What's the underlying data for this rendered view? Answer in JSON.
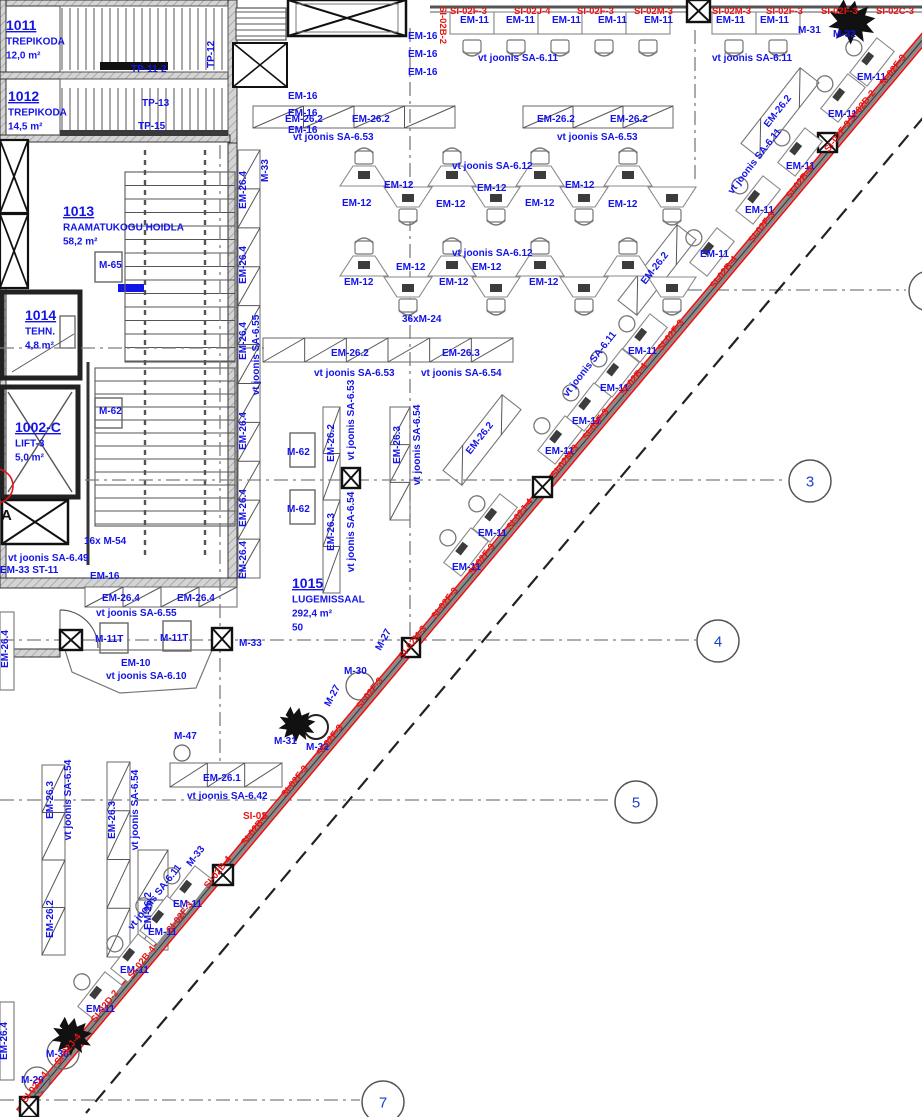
{
  "colors": {
    "annotation_blue": "#1414e8",
    "alert_red": "#e81414",
    "wall_gray": "#c9c9c9",
    "line_dark": "#333333",
    "grid_number_blue": "#1b3fd0"
  },
  "rooms": [
    {
      "number": "1011",
      "name": "TREPIKODA",
      "area": "12,0 m²",
      "x": 6,
      "y": 30
    },
    {
      "number": "1012",
      "name": "TREPIKODA",
      "area": "14,5 m²",
      "x": 8,
      "y": 101
    },
    {
      "number": "1013",
      "name": "RAAMATUKOGU HOIDLA",
      "area": "58,2 m²",
      "x": 63,
      "y": 216
    },
    {
      "number": "1014",
      "name": "TEHN.",
      "area": "4,8 m²",
      "x": 25,
      "y": 320
    },
    {
      "number": "1002-C",
      "name": "LIFT-3",
      "area": "5,0 m²",
      "x": 15,
      "y": 432
    },
    {
      "number": "1015",
      "name": "LUGEMISSAAL",
      "area": "292,4 m²",
      "capacity": "50",
      "x": 292,
      "y": 588
    }
  ],
  "grid_bubbles": [
    {
      "label": "3",
      "x": 810,
      "y": 481
    },
    {
      "label": "4",
      "x": 718,
      "y": 641
    },
    {
      "label": "5",
      "x": 636,
      "y": 802
    },
    {
      "label": "7",
      "x": 383,
      "y": 1102
    }
  ],
  "labels": [
    {
      "t": "TP-11-2",
      "x": 131,
      "y": 72
    },
    {
      "t": "TP-13",
      "x": 142,
      "y": 106
    },
    {
      "t": "TP-15",
      "x": 138,
      "y": 129
    },
    {
      "t": "TP-12",
      "x": 214,
      "y": 68,
      "r": -90
    },
    {
      "t": "M-33",
      "x": 268,
      "y": 182,
      "r": -90
    },
    {
      "t": "M-65",
      "x": 99,
      "y": 268
    },
    {
      "t": "M-62",
      "x": 99,
      "y": 414
    },
    {
      "t": "EM-16",
      "x": 408,
      "y": 39
    },
    {
      "t": "EM-16",
      "x": 408,
      "y": 57
    },
    {
      "t": "EM-16",
      "x": 408,
      "y": 75
    },
    {
      "t": "EM-16",
      "x": 288,
      "y": 99
    },
    {
      "t": "EM-16",
      "x": 288,
      "y": 116
    },
    {
      "t": "EM-16",
      "x": 288,
      "y": 133
    },
    {
      "t": "EM-11",
      "x": 460,
      "y": 23
    },
    {
      "t": "EM-11",
      "x": 506,
      "y": 23
    },
    {
      "t": "EM-11",
      "x": 552,
      "y": 23
    },
    {
      "t": "EM-11",
      "x": 598,
      "y": 23
    },
    {
      "t": "EM-11",
      "x": 644,
      "y": 23
    },
    {
      "t": "EM-11",
      "x": 716,
      "y": 23
    },
    {
      "t": "EM-11",
      "x": 760,
      "y": 23
    },
    {
      "t": "vt joonis SA-6.11",
      "x": 478,
      "y": 61
    },
    {
      "t": "vt joonis SA-6.11",
      "x": 712,
      "y": 61
    },
    {
      "t": "M-31",
      "x": 798,
      "y": 33
    },
    {
      "t": "M-32",
      "x": 833,
      "y": 37
    },
    {
      "t": "SI-02F-3",
      "x": 450,
      "y": 14,
      "c": "r",
      "s": 9.5
    },
    {
      "t": "SI-02J-4",
      "x": 514,
      "y": 14,
      "c": "r",
      "s": 9.5
    },
    {
      "t": "SI-02F-3",
      "x": 577,
      "y": 14,
      "c": "r",
      "s": 9.5
    },
    {
      "t": "SI-02M-3",
      "x": 634,
      "y": 14,
      "c": "r",
      "s": 9.5
    },
    {
      "t": "SI-02M-3",
      "x": 712,
      "y": 14,
      "c": "r",
      "s": 9.5
    },
    {
      "t": "SI-02F-3",
      "x": 766,
      "y": 14,
      "c": "r",
      "s": 9.5
    },
    {
      "t": "SI-02F-3",
      "x": 821,
      "y": 14,
      "c": "r",
      "s": 9.5
    },
    {
      "t": "SI-02C-3",
      "x": 876,
      "y": 14,
      "c": "r",
      "s": 9.5
    },
    {
      "t": "SI-02B-2",
      "x": 440,
      "y": 6,
      "r": 90,
      "c": "r",
      "s": 9.5
    },
    {
      "t": "EM-26.2",
      "x": 285,
      "y": 122
    },
    {
      "t": "EM-26.2",
      "x": 352,
      "y": 122
    },
    {
      "t": "EM-26.2",
      "x": 537,
      "y": 122
    },
    {
      "t": "EM-26.2",
      "x": 610,
      "y": 122
    },
    {
      "t": "vt joonis SA-6.53",
      "x": 293,
      "y": 140
    },
    {
      "t": "vt joonis SA-6.53",
      "x": 557,
      "y": 140
    },
    {
      "t": "vt joonis SA-6.12",
      "x": 452,
      "y": 169
    },
    {
      "t": "EM-12",
      "x": 384,
      "y": 188
    },
    {
      "t": "EM-12",
      "x": 342,
      "y": 206
    },
    {
      "t": "EM-12",
      "x": 477,
      "y": 191
    },
    {
      "t": "EM-12",
      "x": 436,
      "y": 207
    },
    {
      "t": "EM-12",
      "x": 565,
      "y": 188
    },
    {
      "t": "EM-12",
      "x": 525,
      "y": 206
    },
    {
      "t": "EM-12",
      "x": 608,
      "y": 207
    },
    {
      "t": "vt joonis SA-6.12",
      "x": 452,
      "y": 256
    },
    {
      "t": "EM-12",
      "x": 396,
      "y": 270
    },
    {
      "t": "EM-12",
      "x": 472,
      "y": 270
    },
    {
      "t": "EM-12",
      "x": 344,
      "y": 285
    },
    {
      "t": "EM-12",
      "x": 439,
      "y": 285
    },
    {
      "t": "EM-12",
      "x": 529,
      "y": 285
    },
    {
      "t": "36xM-24",
      "x": 402,
      "y": 322
    },
    {
      "t": "EM-26.2",
      "x": 331,
      "y": 356
    },
    {
      "t": "EM-26.3",
      "x": 442,
      "y": 356
    },
    {
      "t": "vt joonis SA-6.53",
      "x": 314,
      "y": 376
    },
    {
      "t": "vt joonis SA-6.54",
      "x": 421,
      "y": 376
    },
    {
      "t": "EM-26.2",
      "x": 334,
      "y": 443,
      "r": -90,
      "a": "m"
    },
    {
      "t": "vt joonis SA-6.53",
      "x": 354,
      "y": 420,
      "r": -90,
      "a": "m"
    },
    {
      "t": "EM-26.3",
      "x": 334,
      "y": 532,
      "r": -90,
      "a": "m"
    },
    {
      "t": "vt joonis SA-6.54",
      "x": 354,
      "y": 532,
      "r": -90,
      "a": "m"
    },
    {
      "t": "EM-26.3",
      "x": 400,
      "y": 445,
      "r": -90,
      "a": "m"
    },
    {
      "t": "vt joonis SA-6.54",
      "x": 420,
      "y": 445,
      "r": -90,
      "a": "m"
    },
    {
      "t": "M-62",
      "x": 287,
      "y": 455
    },
    {
      "t": "M-62",
      "x": 287,
      "y": 512
    },
    {
      "t": "EM-26.4",
      "x": 246,
      "y": 190,
      "r": -90,
      "a": "m"
    },
    {
      "t": "EM-26.4",
      "x": 246,
      "y": 265,
      "r": -90,
      "a": "m"
    },
    {
      "t": "EM-26.4",
      "x": 246,
      "y": 341,
      "r": -90,
      "a": "m"
    },
    {
      "t": "EM-26.4",
      "x": 246,
      "y": 431,
      "r": -90,
      "a": "m"
    },
    {
      "t": "EM-26.4",
      "x": 246,
      "y": 508,
      "r": -90,
      "a": "m"
    },
    {
      "t": "EM-26.4",
      "x": 246,
      "y": 560,
      "r": -90,
      "a": "m"
    },
    {
      "t": "vt joonis SA-6.55",
      "x": 259,
      "y": 355,
      "r": -90,
      "a": "m"
    },
    {
      "t": "16x M-54",
      "x": 84,
      "y": 544
    },
    {
      "t": "vt joonis SA-6.49",
      "x": 8,
      "y": 561
    },
    {
      "t": "EM-33 ST-11",
      "x": 0,
      "y": 573
    },
    {
      "t": "EM-16",
      "x": 90,
      "y": 579
    },
    {
      "t": "EM-26.4",
      "x": 102,
      "y": 601
    },
    {
      "t": "EM-26.4",
      "x": 177,
      "y": 601
    },
    {
      "t": "vt joonis SA-6.55",
      "x": 96,
      "y": 616
    },
    {
      "t": "M-11T",
      "x": 95,
      "y": 642
    },
    {
      "t": "M-11T",
      "x": 160,
      "y": 641
    },
    {
      "t": "M-33",
      "x": 239,
      "y": 646
    },
    {
      "t": "EM-10",
      "x": 121,
      "y": 666
    },
    {
      "t": "vt joonis SA-6.10",
      "x": 106,
      "y": 679
    },
    {
      "t": "M-47",
      "x": 174,
      "y": 739
    },
    {
      "t": "EM-26.1",
      "x": 203,
      "y": 781
    },
    {
      "t": "vt joonis SA-6.42",
      "x": 187,
      "y": 799
    },
    {
      "t": "SI-02",
      "x": 243,
      "y": 819,
      "c": "r"
    },
    {
      "t": "M-27",
      "x": 386,
      "y": 641,
      "r": -62,
      "a": "m"
    },
    {
      "t": "M-30",
      "x": 344,
      "y": 674
    },
    {
      "t": "M-27",
      "x": 335,
      "y": 697,
      "r": -62,
      "a": "m"
    },
    {
      "t": "M-31",
      "x": 274,
      "y": 744
    },
    {
      "t": "M-32",
      "x": 306,
      "y": 750
    },
    {
      "t": "EM-11",
      "x": 857,
      "y": 80
    },
    {
      "t": "EM-11",
      "x": 828,
      "y": 117
    },
    {
      "t": "EM-11",
      "x": 786,
      "y": 169
    },
    {
      "t": "EM-11",
      "x": 745,
      "y": 213
    },
    {
      "t": "EM-11",
      "x": 700,
      "y": 257
    },
    {
      "t": "EM-11",
      "x": 628,
      "y": 354
    },
    {
      "t": "EM-11",
      "x": 600,
      "y": 391
    },
    {
      "t": "EM-11",
      "x": 572,
      "y": 424
    },
    {
      "t": "EM-11",
      "x": 545,
      "y": 454
    },
    {
      "t": "EM-11",
      "x": 478,
      "y": 536
    },
    {
      "t": "EM-11",
      "x": 452,
      "y": 570
    },
    {
      "t": "EM-11",
      "x": 173,
      "y": 907
    },
    {
      "t": "EM-11",
      "x": 148,
      "y": 935
    },
    {
      "t": "EM-11",
      "x": 120,
      "y": 973
    },
    {
      "t": "EM-11",
      "x": 86,
      "y": 1012
    },
    {
      "t": "EM-26.2",
      "x": 780,
      "y": 113,
      "r": -52,
      "a": "m"
    },
    {
      "t": "EM-26.2",
      "x": 657,
      "y": 270,
      "r": -52,
      "a": "m"
    },
    {
      "t": "EM-26.2",
      "x": 482,
      "y": 440,
      "r": -52,
      "a": "m"
    },
    {
      "t": "vt joonis SA-6.11",
      "x": 757,
      "y": 163,
      "r": -52,
      "a": "m"
    },
    {
      "t": "vt joonis SA-6.11",
      "x": 592,
      "y": 366,
      "r": -52,
      "a": "m"
    },
    {
      "t": "vt joonis SA-6.11",
      "x": 157,
      "y": 899,
      "r": -52,
      "a": "m"
    },
    {
      "t": "M-33",
      "x": 198,
      "y": 858,
      "r": -52,
      "a": "m"
    },
    {
      "t": "EM-26.3",
      "x": 53,
      "y": 800,
      "r": -90,
      "a": "m"
    },
    {
      "t": "vt joonis SA-6.54",
      "x": 71,
      "y": 800,
      "r": -90,
      "a": "m"
    },
    {
      "t": "EM-26.2",
      "x": 53,
      "y": 919,
      "r": -90,
      "a": "m"
    },
    {
      "t": "EM-26.3",
      "x": 115,
      "y": 820,
      "r": -90,
      "a": "m"
    },
    {
      "t": "vt joonis SA-6.54",
      "x": 138,
      "y": 810,
      "r": -90,
      "a": "m"
    },
    {
      "t": "EM-26.2",
      "x": 151,
      "y": 911,
      "r": -90,
      "a": "m"
    },
    {
      "t": "EM-26.4",
      "x": 8,
      "y": 649,
      "r": -90,
      "a": "m"
    },
    {
      "t": "EM-26.4",
      "x": 7,
      "y": 1041,
      "r": -90,
      "a": "m"
    },
    {
      "t": "M-30",
      "x": 46,
      "y": 1057
    },
    {
      "t": "M-29",
      "x": 21,
      "y": 1083
    },
    {
      "t": "SI-02F-3",
      "x": 895,
      "y": 72,
      "r": -52,
      "a": "m",
      "c": "r",
      "s": 9.5
    },
    {
      "t": "SI-02D-2",
      "x": 864,
      "y": 108,
      "r": -52,
      "a": "m",
      "c": "r",
      "s": 9.5
    },
    {
      "t": "SI-02F-3",
      "x": 840,
      "y": 138,
      "r": -52,
      "a": "m",
      "c": "r",
      "s": 9.5
    },
    {
      "t": "SI-02B-4",
      "x": 802,
      "y": 184,
      "r": -52,
      "a": "m",
      "c": "r",
      "s": 9.5
    },
    {
      "t": "SI-02F-3",
      "x": 764,
      "y": 229,
      "r": -52,
      "a": "m",
      "c": "r",
      "s": 9.5
    },
    {
      "t": "SI-02B-4",
      "x": 726,
      "y": 274,
      "r": -52,
      "a": "m",
      "c": "r",
      "s": 9.5
    },
    {
      "t": "SI-02F-3",
      "x": 673,
      "y": 337,
      "r": -52,
      "a": "m",
      "c": "r",
      "s": 9.5
    },
    {
      "t": "SI-02B-4",
      "x": 636,
      "y": 381,
      "r": -52,
      "a": "m",
      "c": "r",
      "s": 9.5
    },
    {
      "t": "SI-02F-3",
      "x": 598,
      "y": 426,
      "r": -52,
      "a": "m",
      "c": "r",
      "s": 9.5
    },
    {
      "t": "SI-02M-3",
      "x": 567,
      "y": 463,
      "r": -52,
      "a": "m",
      "c": "r",
      "s": 9.5
    },
    {
      "t": "SI-02J-4",
      "x": 522,
      "y": 516,
      "r": -52,
      "a": "m",
      "c": "r",
      "s": 9.5
    },
    {
      "t": "SI-02F-3",
      "x": 484,
      "y": 561,
      "r": -52,
      "a": "m",
      "c": "r",
      "s": 9.5
    },
    {
      "t": "SI-02F-3",
      "x": 447,
      "y": 605,
      "r": -52,
      "a": "m",
      "c": "r",
      "s": 9.5
    },
    {
      "t": "SI-02M-3",
      "x": 415,
      "y": 644,
      "r": -52,
      "a": "m",
      "c": "r",
      "s": 9.5
    },
    {
      "t": "SI-02F-3",
      "x": 372,
      "y": 695,
      "r": -52,
      "a": "m",
      "c": "r",
      "s": 9.5
    },
    {
      "t": "SI-02F-3",
      "x": 332,
      "y": 742,
      "r": -52,
      "a": "m",
      "c": "r",
      "s": 9.5
    },
    {
      "t": "SI-02F-3",
      "x": 297,
      "y": 783,
      "r": -52,
      "a": "m",
      "c": "r",
      "s": 9.5
    },
    {
      "t": "SI-02B-4",
      "x": 257,
      "y": 831,
      "r": -52,
      "a": "m",
      "c": "r",
      "s": 9.5
    },
    {
      "t": "SI-02B-4",
      "x": 220,
      "y": 874,
      "r": -52,
      "a": "m",
      "c": "r",
      "s": 9.5
    },
    {
      "t": "SI-02F-3",
      "x": 182,
      "y": 919,
      "r": -52,
      "a": "m",
      "c": "r",
      "s": 9.5
    },
    {
      "t": "SI-02B-4",
      "x": 144,
      "y": 964,
      "r": -52,
      "a": "m",
      "c": "r",
      "s": 9.5
    },
    {
      "t": "SI-02D-2",
      "x": 107,
      "y": 1008,
      "r": -52,
      "a": "m",
      "c": "r",
      "s": 9.5
    },
    {
      "t": "SI-02J-4",
      "x": 70,
      "y": 1051,
      "r": -52,
      "a": "m",
      "c": "r",
      "s": 9.5
    },
    {
      "t": "SI-02J-4",
      "x": 37,
      "y": 1089,
      "r": -52,
      "a": "m",
      "c": "r",
      "s": 9.5
    },
    {
      "t": "A",
      "x": 1,
      "y": 520,
      "c": "k",
      "s": 15
    }
  ]
}
